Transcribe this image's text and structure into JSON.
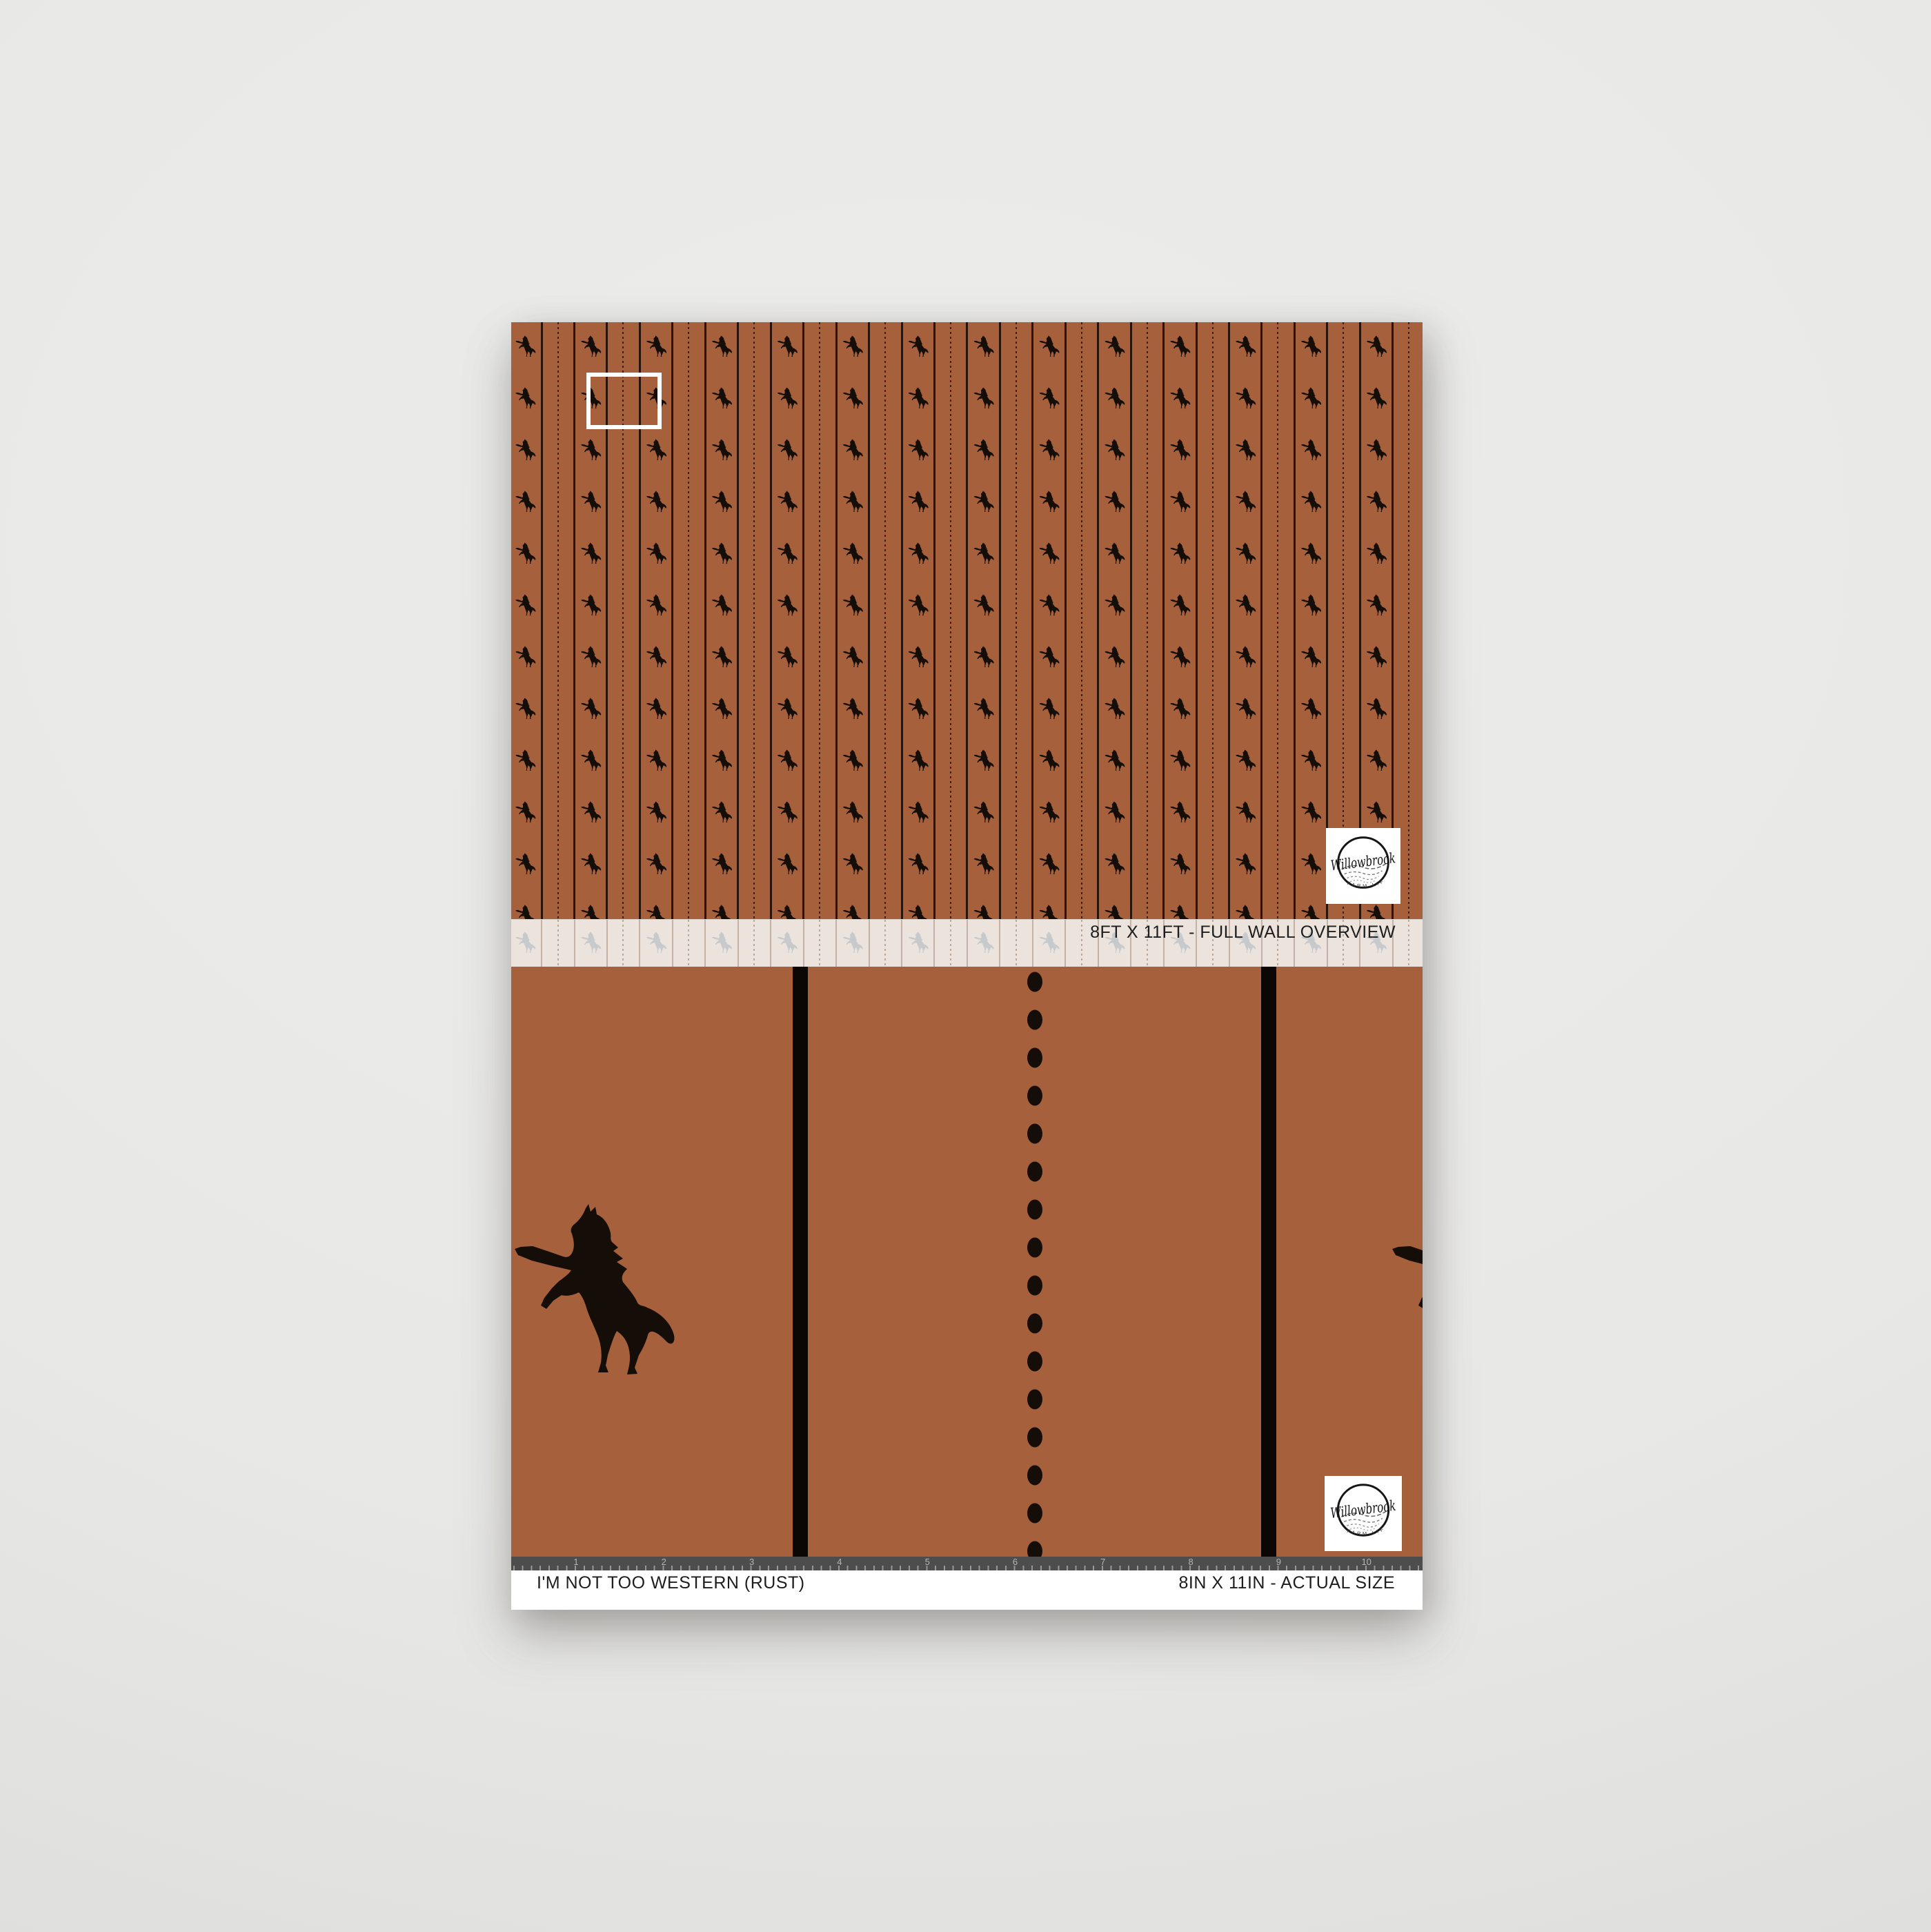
{
  "wall_overview": {
    "label": "8FT X 11FT - FULL WALL OVERVIEW"
  },
  "actual_size": {
    "label_left": "I'M NOT TOO WESTERN (RUST)",
    "label_right": "8IN X 11IN - ACTUAL SIZE",
    "ruler_numbers": [
      "1",
      "2",
      "3",
      "4",
      "5",
      "6",
      "7",
      "8",
      "9",
      "10"
    ]
  },
  "brand": {
    "name": "Willowbrook",
    "tagline": "FARM LIFE"
  },
  "wallpaper": {
    "pattern_name": "I'm Not Too Western",
    "colorway": "Rust",
    "motif": "rearing-horse-silhouette",
    "stripe_elements": [
      "solid-pinstripe",
      "dotted-pinstripe"
    ]
  },
  "colors": {
    "backdrop": "#e8e8e6",
    "rust": "#a6613c",
    "stripe_line": "#2a140a",
    "stripe_dot": "#401e0e",
    "motif_ink": "#150d08",
    "bar_black": "#0b0705",
    "cream_strip": "#ece3dc",
    "ghost_motif": "#bdc5ca",
    "ruler_bg": "#4d4d4d",
    "ruler_text": "#b5b5b5",
    "label_text": "#1d1d1d",
    "paper_white": "#ffffff"
  }
}
